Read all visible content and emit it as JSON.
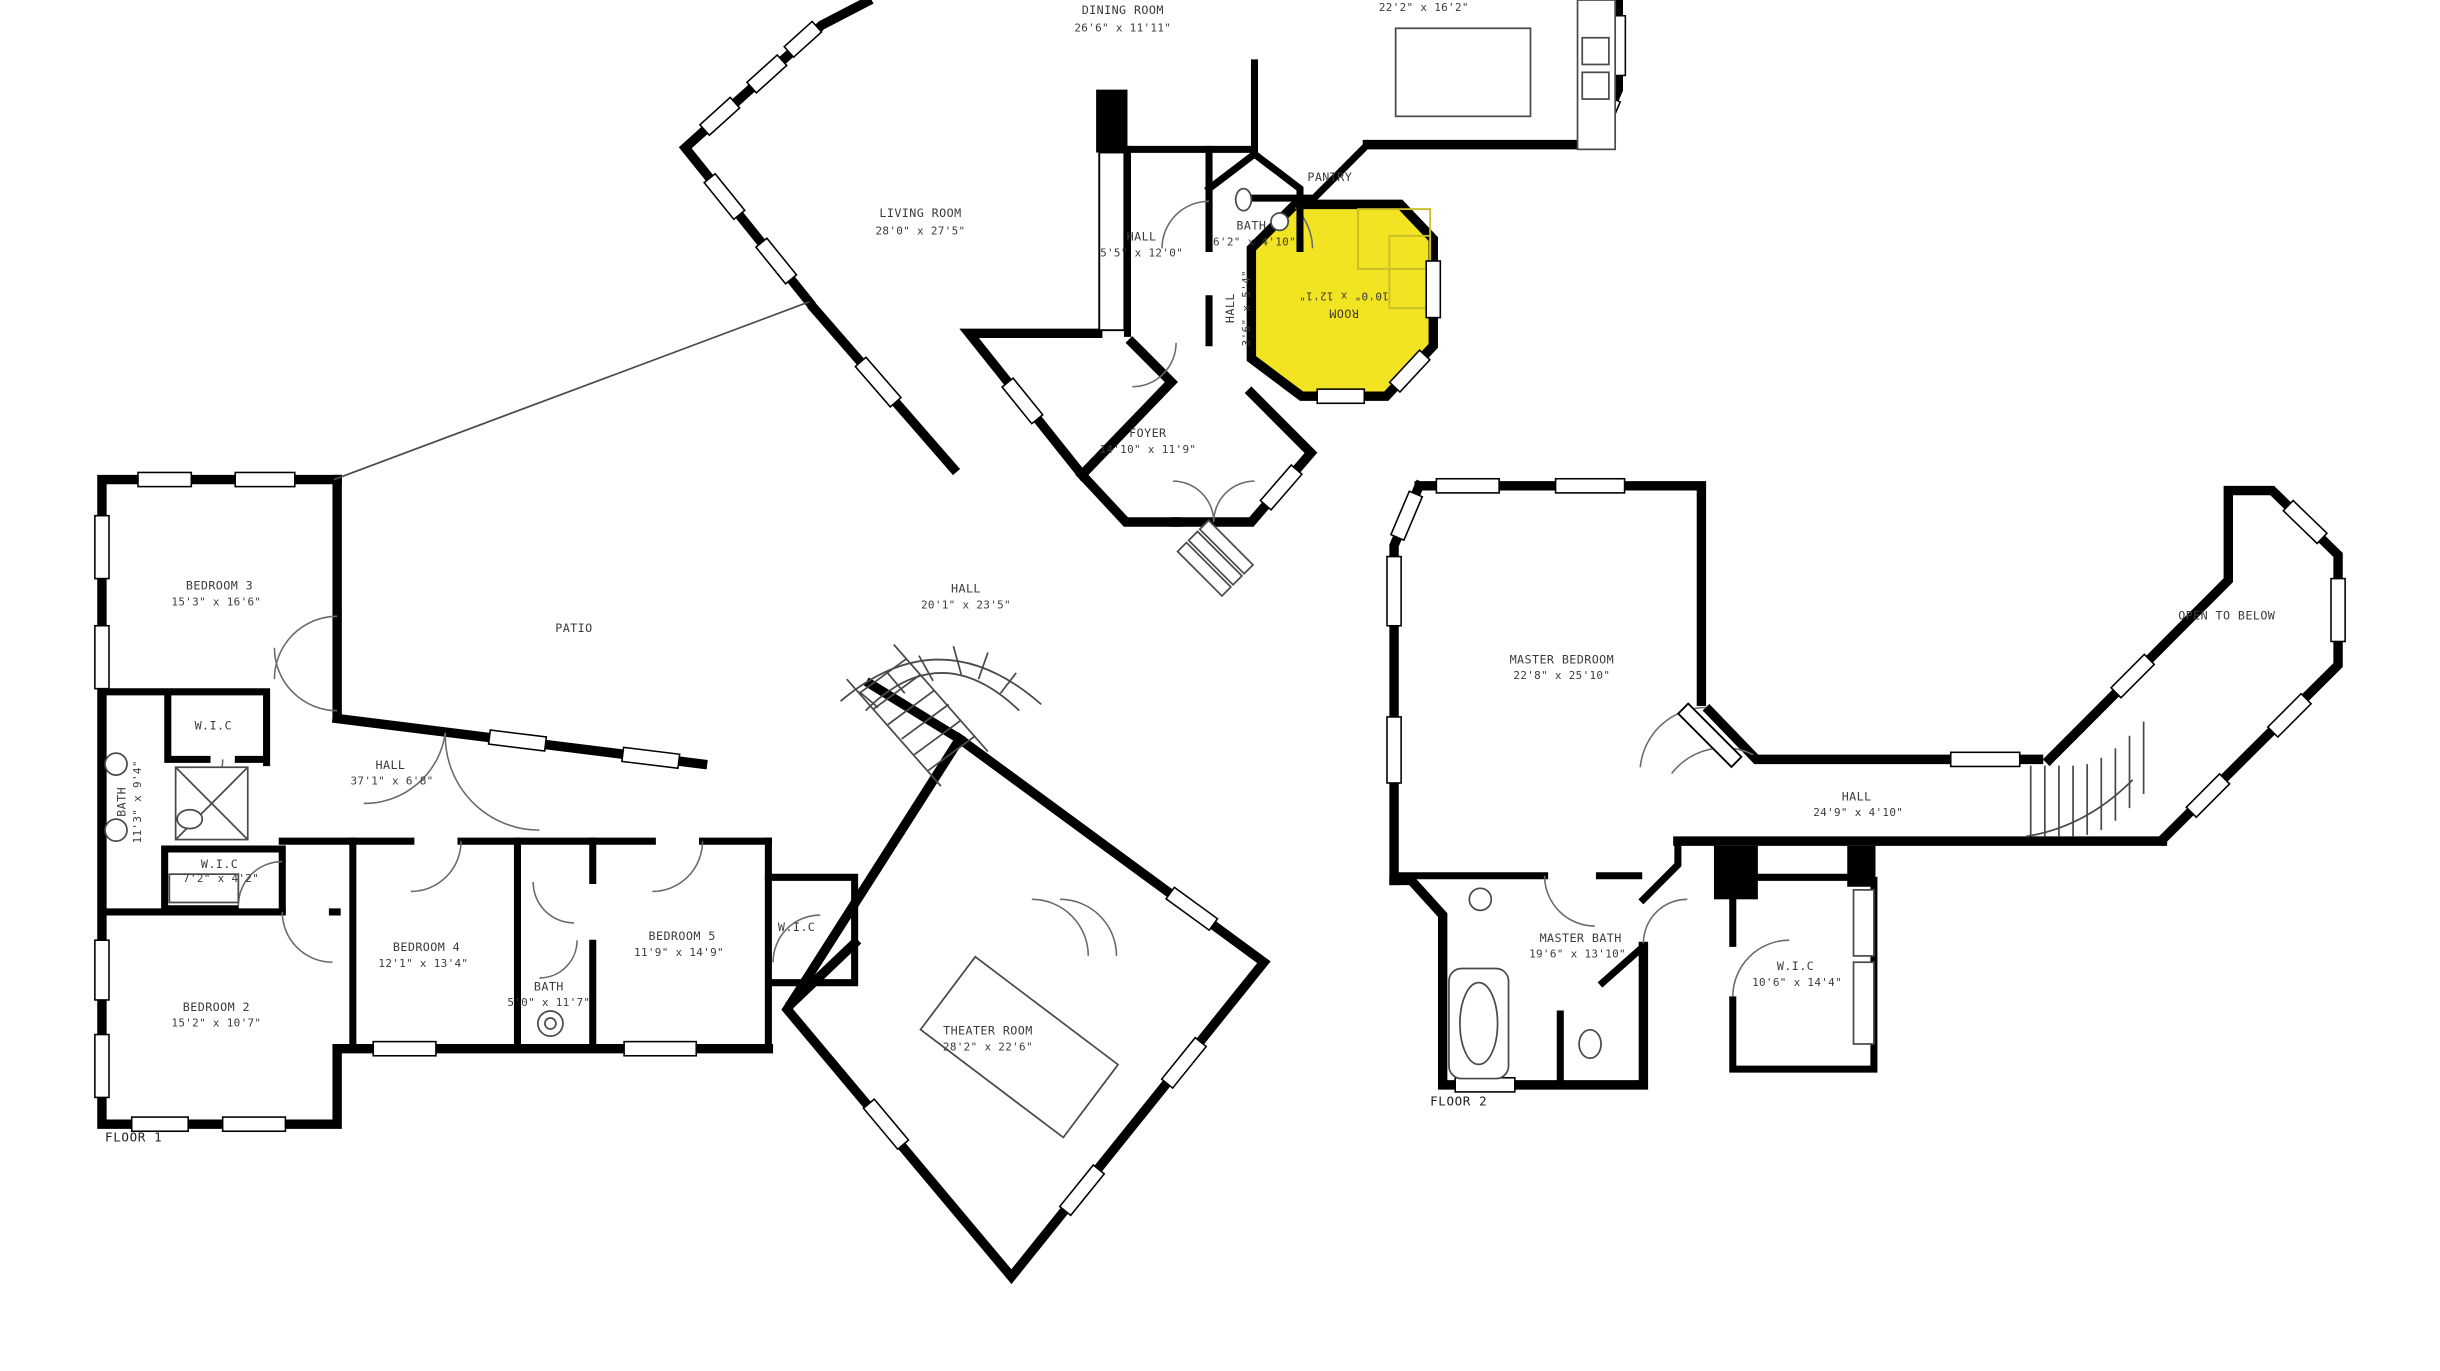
{
  "document": {
    "type": "floor-plan",
    "floors_shown": 2
  },
  "colors": {
    "walls": "#000000",
    "highlight_room_fill": "#f2e422",
    "highlight_room_furniture": "#c9bd2a",
    "thin_lines": "#4a4a4a",
    "text": "#3b3b3b",
    "background": "#ffffff"
  },
  "floor1": {
    "name": "FLOOR 1",
    "rooms": {
      "dining": {
        "label": "DINING ROOM",
        "dims": "26'6\" x 11'11\""
      },
      "kitchen": {
        "dims": "22'2\" x 16'2\""
      },
      "living": {
        "label": "LIVING ROOM",
        "dims": "28'0\" x 27'5\""
      },
      "hall_upper": {
        "label": "HALL",
        "dims": "5'5\" x 12'0\""
      },
      "powder_bath": {
        "label": "BATH",
        "dims": "6'2\" x 4'10\""
      },
      "pantry": {
        "label": "PANTRY"
      },
      "highlighted_room": {
        "label": "ROOM",
        "dims": "10'0\" x 12'1\"",
        "highlighted": true,
        "text_rotation_deg": 180
      },
      "hall_small": {
        "label": "HALL",
        "dims": "3'6\" x 5'4\"",
        "text_rotation_deg": -90
      },
      "foyer": {
        "label": "FOYER",
        "dims": "14'10\" x 11'9\""
      },
      "hall_center": {
        "label": "HALL",
        "dims": "20'1\" x 23'5\""
      },
      "patio": {
        "label": "PATIO"
      },
      "bedroom3": {
        "label": "BEDROOM 3",
        "dims": "15'3\" x 16'6\""
      },
      "wic_bedroom3": {
        "label": "W.I.C"
      },
      "hall_bedrooms": {
        "label": "HALL",
        "dims": "37'1\" x 6'8\""
      },
      "bath_main": {
        "label": "BATH",
        "dims": "11'3\" x 9'4\"",
        "text_rotation_deg": -90
      },
      "wic_bedroom2": {
        "label": "W.I.C",
        "dims": "7'2\" x 4'2\""
      },
      "bedroom2": {
        "label": "BEDROOM 2",
        "dims": "15'2\" x 10'7\""
      },
      "bedroom4": {
        "label": "BEDROOM 4",
        "dims": "12'1\" x 13'4\""
      },
      "bath_hall": {
        "label": "BATH",
        "dims": "5'0\" x 11'7\""
      },
      "bedroom5": {
        "label": "BEDROOM 5",
        "dims": "11'9\" x 14'9\""
      },
      "wic_bedroom5": {
        "label": "W.I.C"
      },
      "theater": {
        "label": "THEATER ROOM",
        "dims": "28'2\" x 22'6\""
      }
    }
  },
  "floor2": {
    "name": "FLOOR 2",
    "rooms": {
      "master_bedroom": {
        "label": "MASTER BEDROOM",
        "dims": "22'8\" x 25'10\""
      },
      "open_to_below": {
        "label": "OPEN TO BELOW"
      },
      "hall": {
        "label": "HALL",
        "dims": "24'9\" x 4'10\""
      },
      "master_bath": {
        "label": "MASTER BATH",
        "dims": "19'6\" x 13'10\""
      },
      "wic_master": {
        "label": "W.I.C",
        "dims": "10'6\" x 14'4\""
      }
    }
  }
}
